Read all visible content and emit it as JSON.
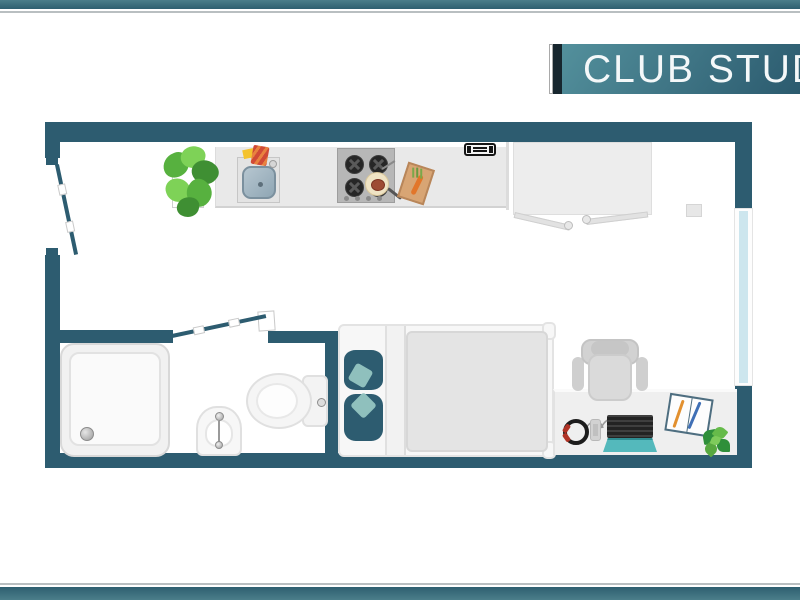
{
  "banner": {
    "title": "CLUB STUD"
  },
  "colors": {
    "frame_teal_light": "#4b7e8a",
    "frame_teal_dark": "#2e5f70",
    "frame_silver": "#b9bfc1",
    "banner_dark": "#17262e",
    "banner_teal_light": "#53909c",
    "banner_teal_dark": "#2b5a6e",
    "banner_text": "#f4f8f9",
    "wall": "#2d5c70",
    "window_glass": "#cde6ee",
    "floor": "#ffffff",
    "counter": "#e9e9e9",
    "hob": "#b7b7b7",
    "wardrobe": "#ededed",
    "desk": "#efefef",
    "bed_duvet": "#e4e4e4",
    "pillow": "#2d5c70",
    "pillow_accent": "#8fc0bd",
    "laptop_base": "#54b9bc",
    "plant_dark": "#3f8f33",
    "plant_light": "#7ed257"
  },
  "floorplan": {
    "type": "studio-apartment-top-view",
    "fixtures": [
      "entry-door",
      "kitchen-counter",
      "kitchen-sink",
      "gas-hob",
      "frying-pan",
      "cutting-board",
      "wall-vent",
      "potted-plant",
      "wardrobe",
      "window",
      "bathroom-door",
      "shower-tray",
      "bidet",
      "toilet",
      "double-bed",
      "desk",
      "office-chair",
      "headphones",
      "phone",
      "laptop",
      "notebook",
      "desk-plant"
    ]
  }
}
